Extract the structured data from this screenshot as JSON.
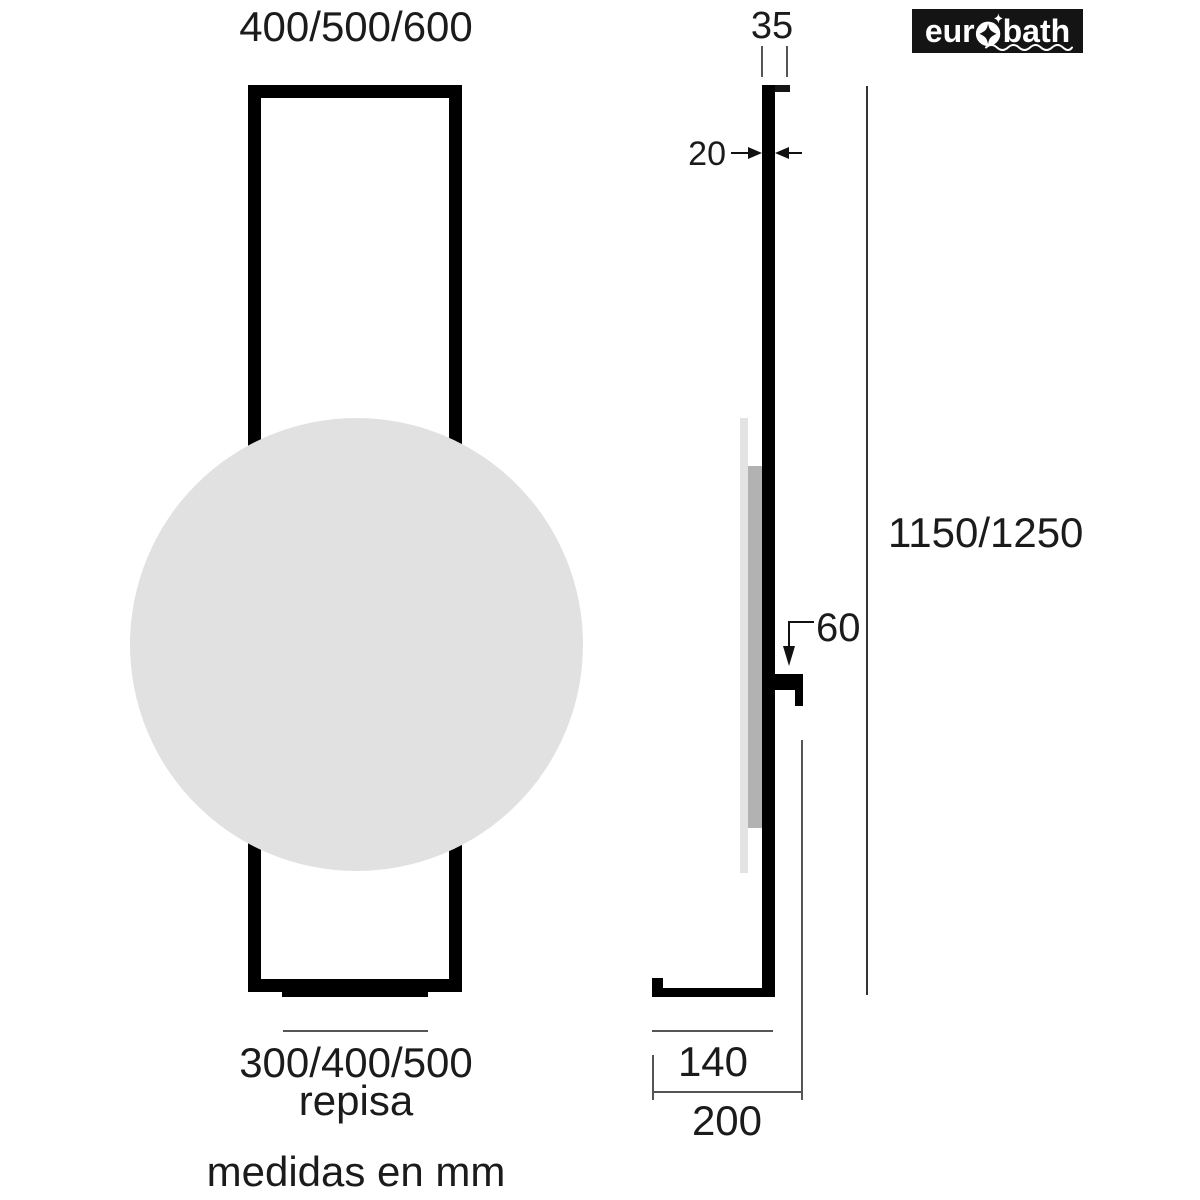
{
  "brand": {
    "part1": "eur",
    "part2": "bath"
  },
  "front_view": {
    "width_options_label": "400/500/600",
    "shelf_width_options_label": "300/400/500",
    "shelf_name_label": "repisa"
  },
  "side_view": {
    "top_depth_label": "35",
    "profile_thickness_label": "20",
    "height_options_label": "1150/1250",
    "hook_offset_label": "60",
    "foot_depth_label": "140",
    "total_depth_label": "200"
  },
  "footer": {
    "units_note": "medidas en mm"
  },
  "colors": {
    "ink": "#1b1b1b",
    "profile": "#000000",
    "mirror_fill": "#e1e1e1",
    "glass_side": "#b2b2b2",
    "thin_line": "#555555",
    "logo_bg": "#141414",
    "logo_fg": "#ffffff"
  }
}
